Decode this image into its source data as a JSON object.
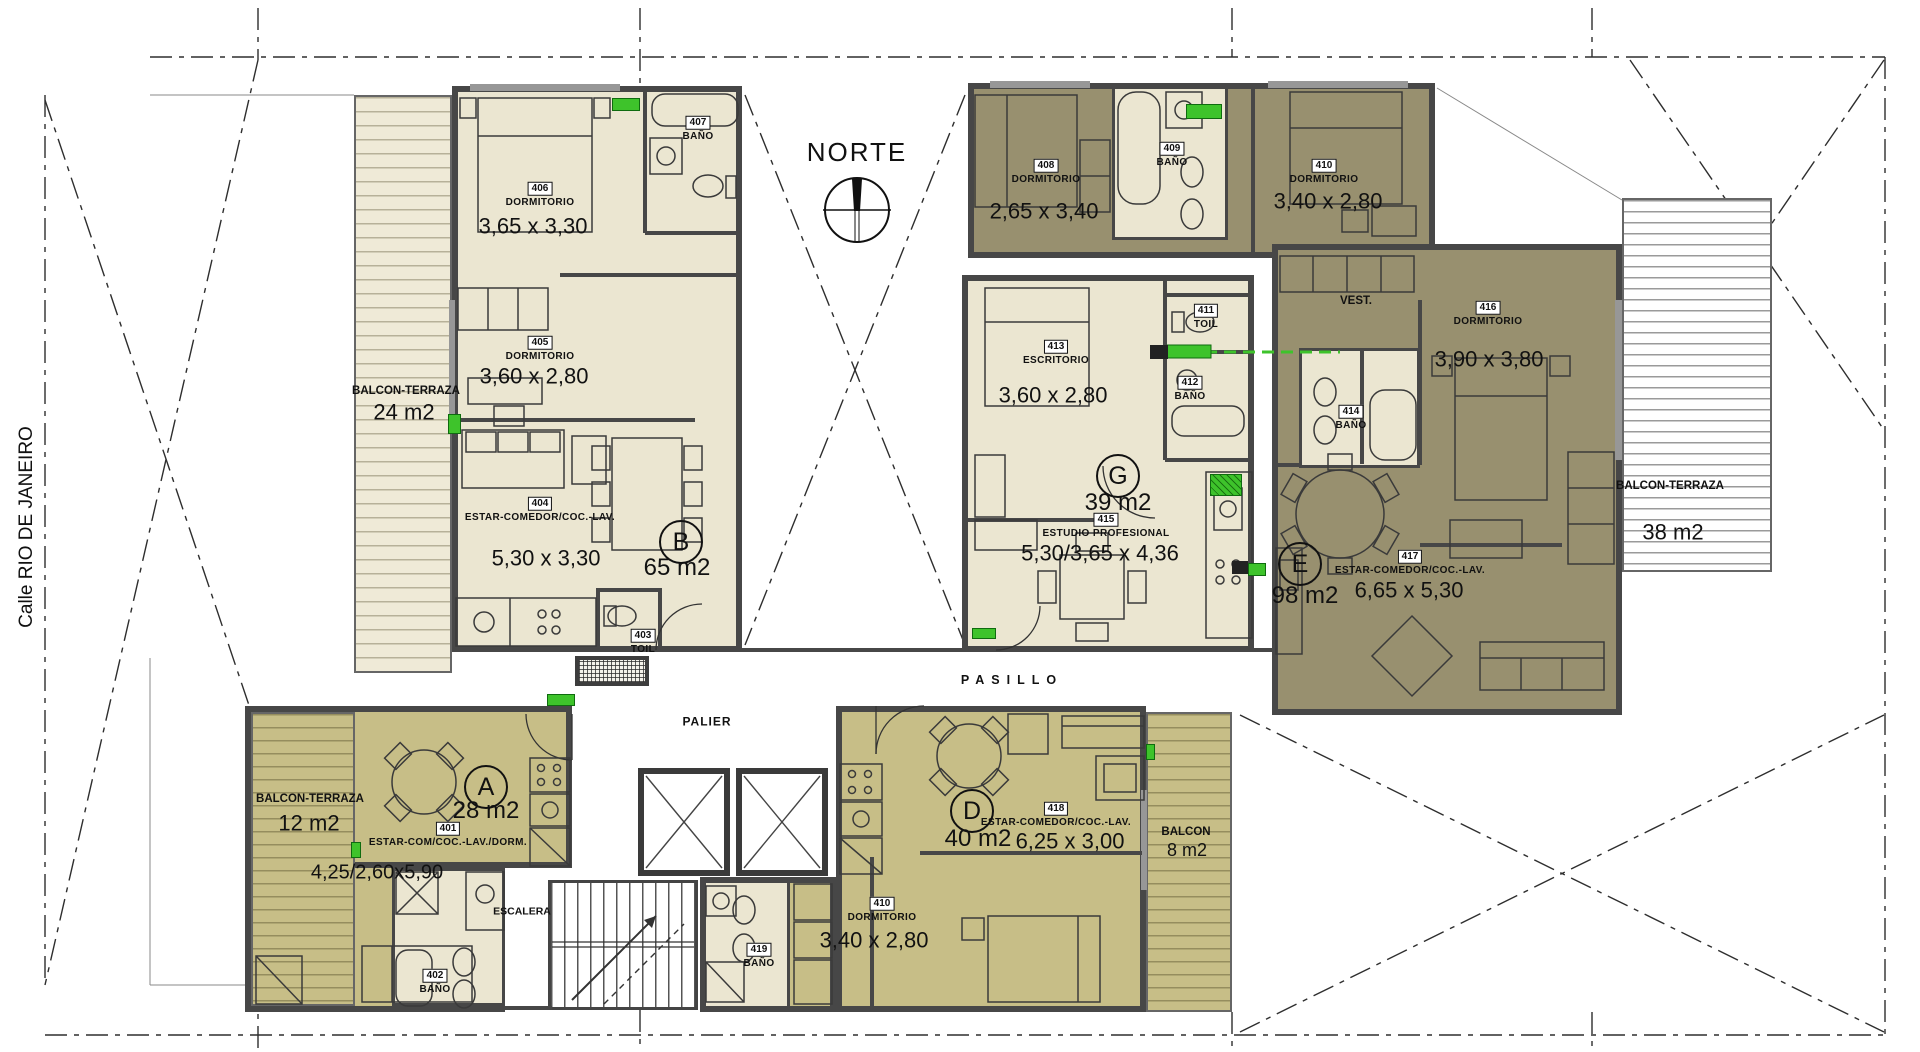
{
  "compass": {
    "label": "NORTE"
  },
  "street": {
    "label": "Calle  RIO DE JANEIRO"
  },
  "circulation": {
    "pasillo": "PASILLO",
    "palier": "PALIER",
    "escalera": "ESCALERA"
  },
  "colors": {
    "cream": "#ebe6d1",
    "olive": "#98906f",
    "ochre": "#c7be87",
    "wall": "#474747",
    "green": "#3ec32b"
  },
  "units": {
    "b": {
      "letter": "B",
      "area": "65 m2",
      "living": {
        "no": "404",
        "name": "ESTAR-COMEDOR/COC.-LAV.",
        "dims": "5,30 x 3,30"
      },
      "dorm1": {
        "no": "406",
        "name": "DORMITORIO",
        "dims": "3,65 x 3,30"
      },
      "dorm2": {
        "no": "405",
        "name": "DORMITORIO",
        "dims": "3,60 x 2,80"
      },
      "bath": {
        "no": "407",
        "name": "BAÑO"
      },
      "toilet": {
        "no": "403",
        "name": "TOIL"
      },
      "balcony": {
        "name": "BALCON-TERRAZA",
        "area": "24 m2"
      }
    },
    "a": {
      "letter": "A",
      "area": "28 m2",
      "living": {
        "no": "401",
        "name": "ESTAR-COM/COC.-LAV./DORM.",
        "dims": "4,25/2,60x5,90"
      },
      "bath": {
        "no": "402",
        "name": "BAÑO"
      },
      "balcony": {
        "name": "BALCON-TERRAZA",
        "area": "12 m2"
      }
    },
    "d": {
      "letter": "D",
      "area": "40 m2",
      "living": {
        "no": "418",
        "name": "ESTAR-COMEDOR/COC.-LAV.",
        "dims": "6,25 x 3,00"
      },
      "dorm": {
        "no": "410",
        "name": "DORMITORIO",
        "dims": "3,40 x 2,80"
      },
      "bath": {
        "no": "419",
        "name": "BAÑO"
      },
      "balcony": {
        "name": "BALCON",
        "area": "8 m2"
      }
    },
    "g": {
      "letter": "G",
      "area": "39 m2",
      "studio": {
        "no": "415",
        "name": "ESTUDIO PROFESIONAL",
        "dims": "5,30/3,65 x 4,36"
      },
      "office": {
        "no": "413",
        "name": "ESCRITORIO",
        "dims": "3,60 x 2,80"
      },
      "bath": {
        "no": "412",
        "name": "BAÑO"
      },
      "toilet": {
        "no": "411",
        "name": "TOIL"
      }
    },
    "e": {
      "letter": "E",
      "area": "98 m2",
      "living": {
        "no": "417",
        "name": "ESTAR-COMEDOR/COC.-LAV.",
        "dims": "6,65 x 5,30"
      },
      "dorm1": {
        "no": "408",
        "name": "DORMITORIO",
        "dims": "2,65 x 3,40"
      },
      "dorm2": {
        "no": "410",
        "name": "DORMITORIO",
        "dims": "3,40 x 2,80"
      },
      "dorm3": {
        "no": "416",
        "name": "DORMITORIO",
        "dims": "3,90 x 3,80"
      },
      "bath1": {
        "no": "409",
        "name": "BAÑO"
      },
      "bath2": {
        "no": "414",
        "name": "BAÑO"
      },
      "vest": {
        "name": "VEST."
      },
      "balcony": {
        "name": "BALCON-TERRAZA",
        "area": "38 m2"
      }
    }
  }
}
